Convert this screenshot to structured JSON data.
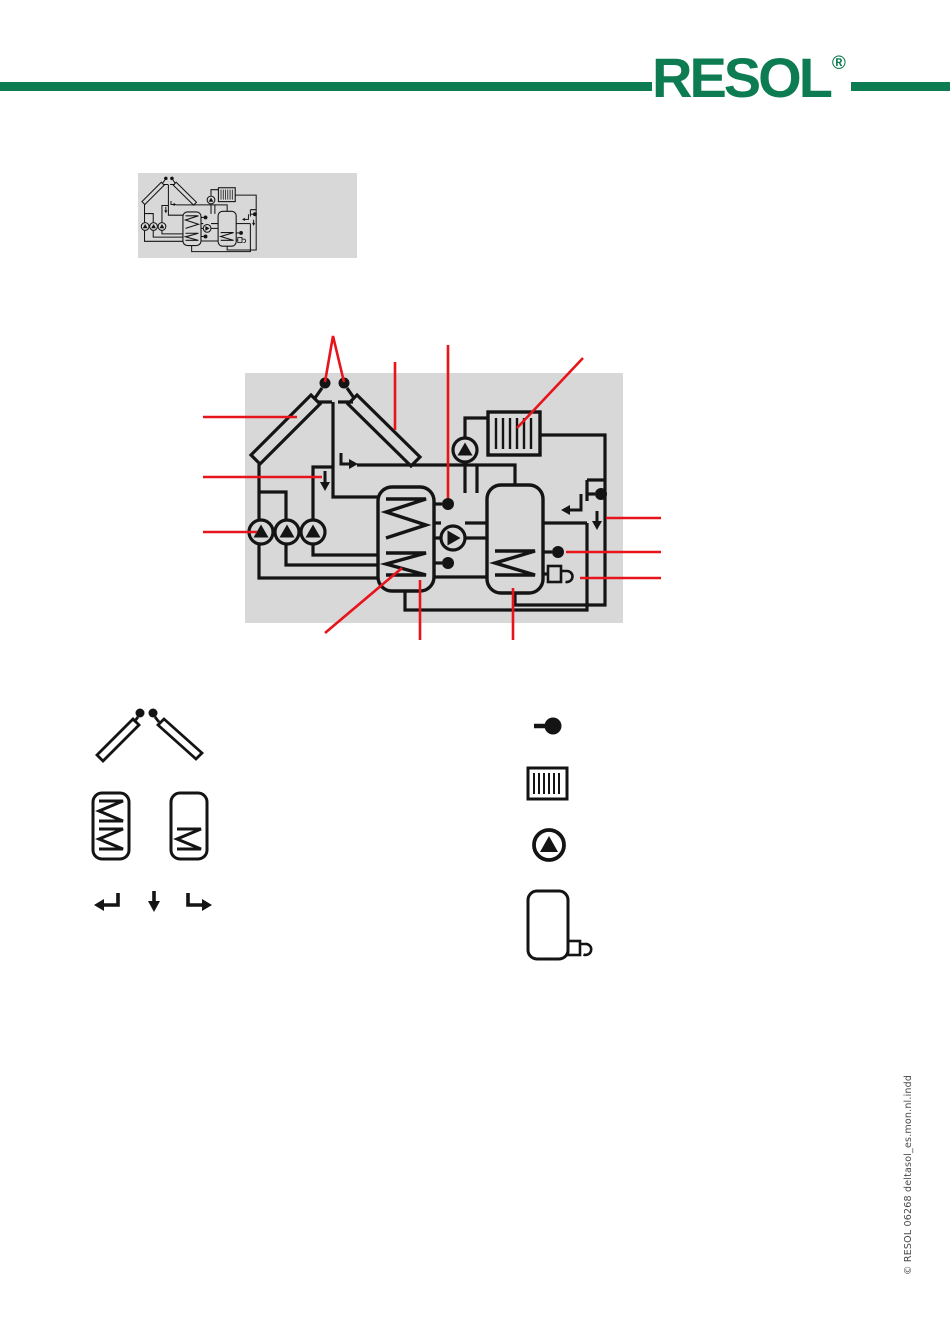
{
  "header": {
    "logo_text": "RESOL",
    "logo_registered": "®",
    "brand_green": "#0E7C52"
  },
  "colors": {
    "diagram_background": "#D8D8D8",
    "schematic_line": "#141414",
    "annotation_red": "#E8141C",
    "page_background": "#FFFFFF"
  },
  "thumbnail": {
    "name": "system-scheme-thumbnail"
  },
  "diagram": {
    "name": "solar-heating-system-scheme",
    "components": [
      "collector-left",
      "collector-right",
      "collector-sensor-1",
      "collector-sensor-2",
      "solar-pump-1",
      "solar-pump-2",
      "solar-pump-3",
      "storage-tank-1",
      "storage-tank-2",
      "charge-pump",
      "radiator",
      "heating-pump",
      "tank1-top-sensor",
      "tank1-bottom-sensor",
      "return-sensor",
      "tank2-sensor",
      "dhw-valve",
      "return-arrow",
      "cold-inlet-arrow",
      "branch-arrow"
    ],
    "callouts": [
      "collector-sensors",
      "collector-right",
      "collector-left",
      "flow-arrow-left",
      "solar-pumps",
      "tank1-top-sensor",
      "radiator",
      "cold-inlet-right",
      "tank2-sensor",
      "dhw-valve",
      "tank1-lower-coil",
      "tank1",
      "tank2"
    ]
  },
  "legend": {
    "left_items": [
      {
        "icon": "collector-pair-with-sensors"
      },
      {
        "icon": "storage-tank-two-coils"
      },
      {
        "icon": "storage-tank-one-coil"
      },
      {
        "icon": "return-arrow"
      },
      {
        "icon": "down-arrow"
      },
      {
        "icon": "branch-arrow"
      }
    ],
    "right_items": [
      {
        "icon": "temperature-sensor"
      },
      {
        "icon": "radiator"
      },
      {
        "icon": "pump"
      },
      {
        "icon": "tank-with-valve"
      }
    ]
  },
  "footer": {
    "imprint": "© RESOL 06268 deltasol_es.mon.nl.indd"
  }
}
